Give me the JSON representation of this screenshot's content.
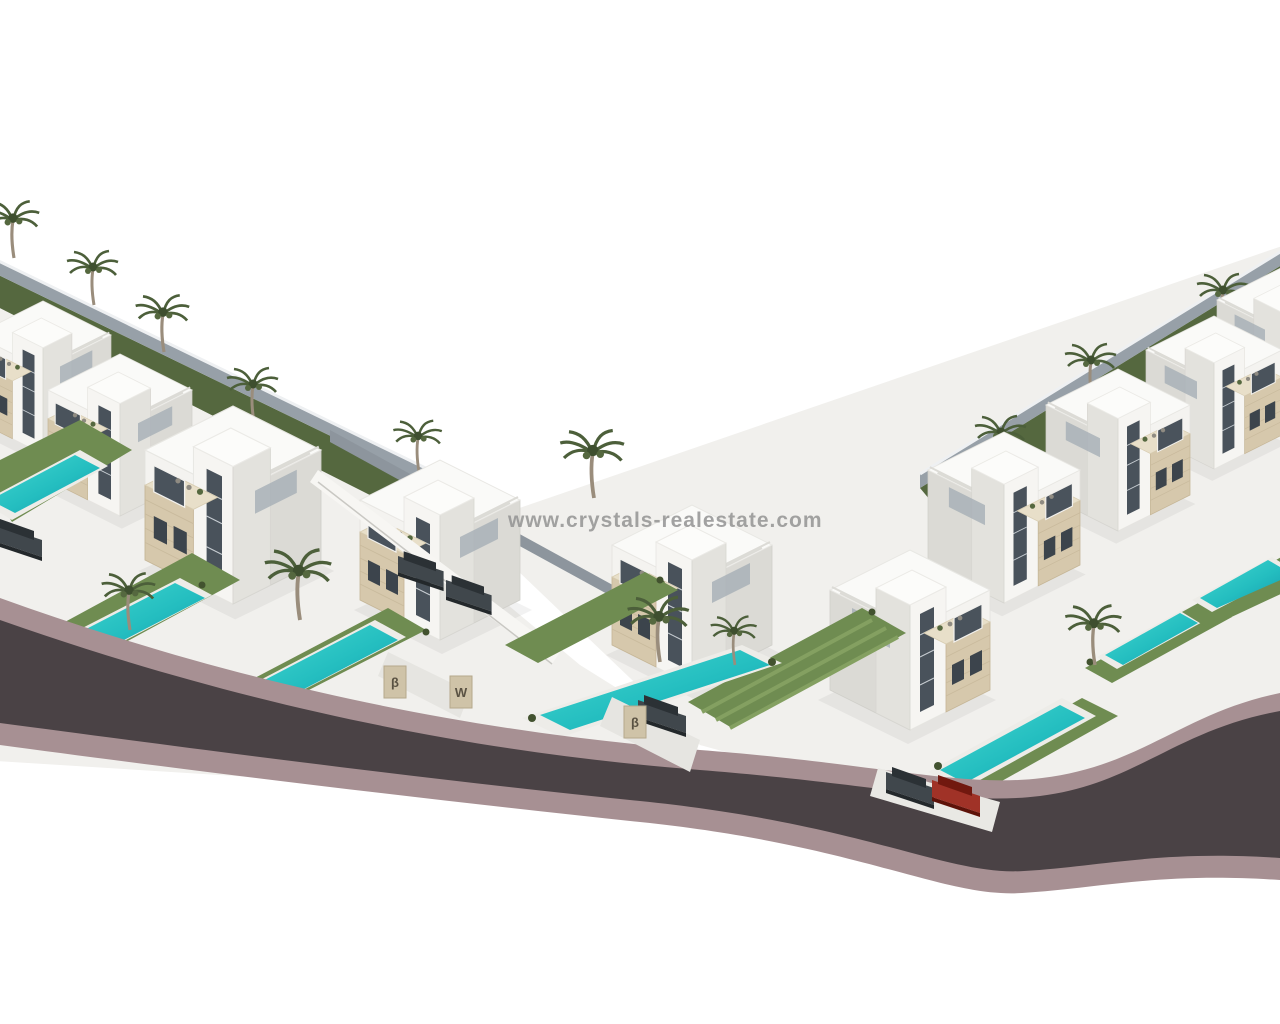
{
  "image": {
    "type": "3d-architectural-render",
    "description": "Aerial isometric 3D render of a modern luxury villa development: two rows of white cubic villas with beige stone accent volumes, rooftop terraces, turquoise private pools, striped lawns, palm trees and parked cars, arranged along an S-curved asphalt road with mauve curbs on a white background.",
    "background_color": "#ffffff"
  },
  "watermark": {
    "text": "www.crystals-realestate.com",
    "color": "#8f8f8f"
  },
  "scene": {
    "villas": {
      "count": 10,
      "style": "modern two-storey white villas with beige travertine feature cube, glazed tower stairwell and roof terrace"
    },
    "pools": {
      "count": 7,
      "water_color": "#2fc9c6"
    },
    "palm_trees": {
      "count": 14,
      "foliage_color": "#4c5f3a"
    },
    "lawns": {
      "color": "#6f8c51",
      "stripe_color": "#84a061"
    },
    "road": {
      "asphalt_color": "#4a4245",
      "curb_color": "#a79093",
      "shape": "s-curve sweeping from left edge down to bottom centre-right then up to right edge"
    },
    "stone_color": "#d6c8ac",
    "fence_color": "#97a0a8",
    "cars": [
      {
        "id": "car-left-edge",
        "color": "dark-gray"
      },
      {
        "id": "car-villa-c-1",
        "color": "dark-gray"
      },
      {
        "id": "car-villa-c-2",
        "color": "dark-gray"
      },
      {
        "id": "car-center-driveway",
        "color": "dark-gray"
      },
      {
        "id": "car-right-driveway-1",
        "color": "dark-gray"
      },
      {
        "id": "car-right-driveway-2",
        "color": "red"
      }
    ],
    "gate_pillars": [
      {
        "label": "β"
      },
      {
        "label": "W"
      },
      {
        "label": "β"
      }
    ]
  }
}
